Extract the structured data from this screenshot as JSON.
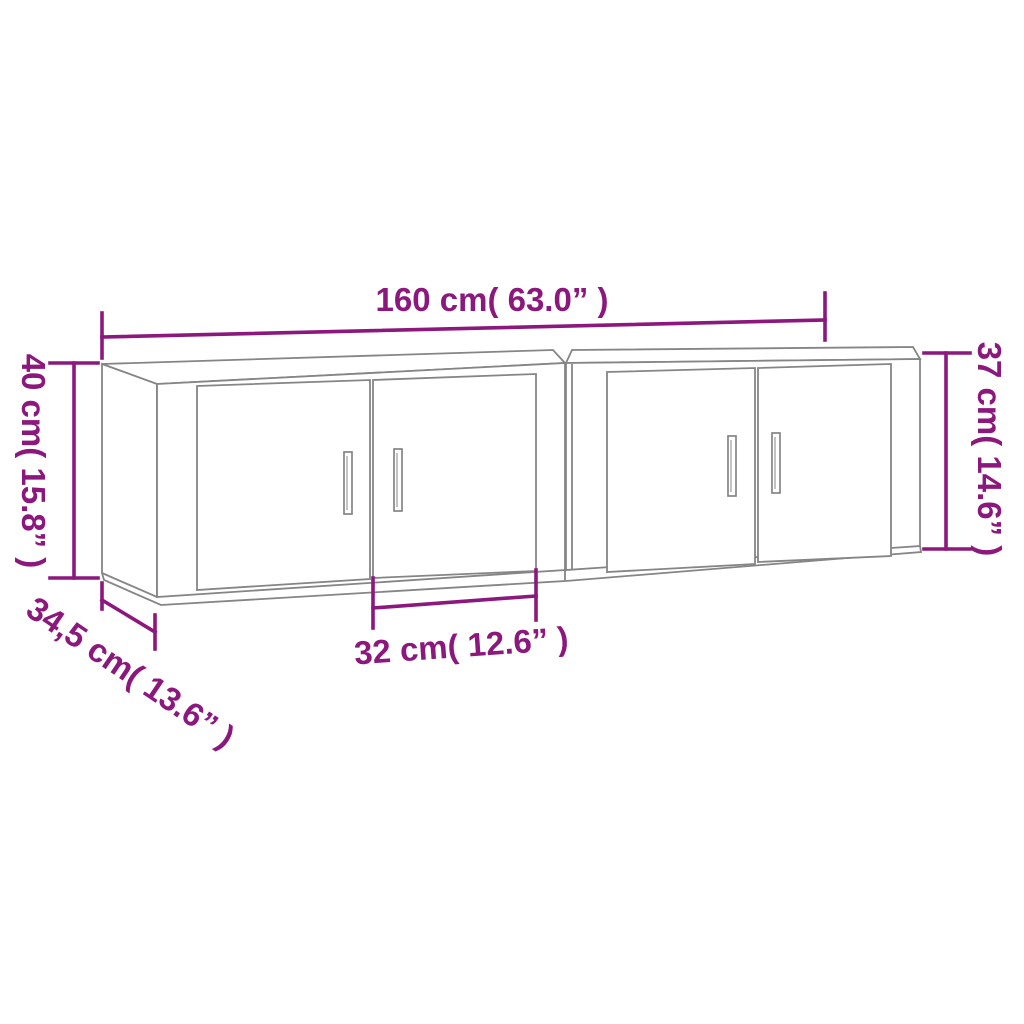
{
  "image": {
    "kind": "product-dimension-diagram",
    "subject": "two wall-mounted TV cabinets, line drawing in perspective",
    "background_color": "#ffffff",
    "outline_color": "#858585",
    "dimension_color": "#8C187E"
  },
  "dimensions": {
    "total_width": "160 cm( 63.0” )",
    "left_height": "40 cm( 15.8” )",
    "right_height": "37 cm( 14.6” )",
    "depth": "34,5 cm( 13.6” )",
    "door_width": "32 cm( 12.6” )"
  }
}
